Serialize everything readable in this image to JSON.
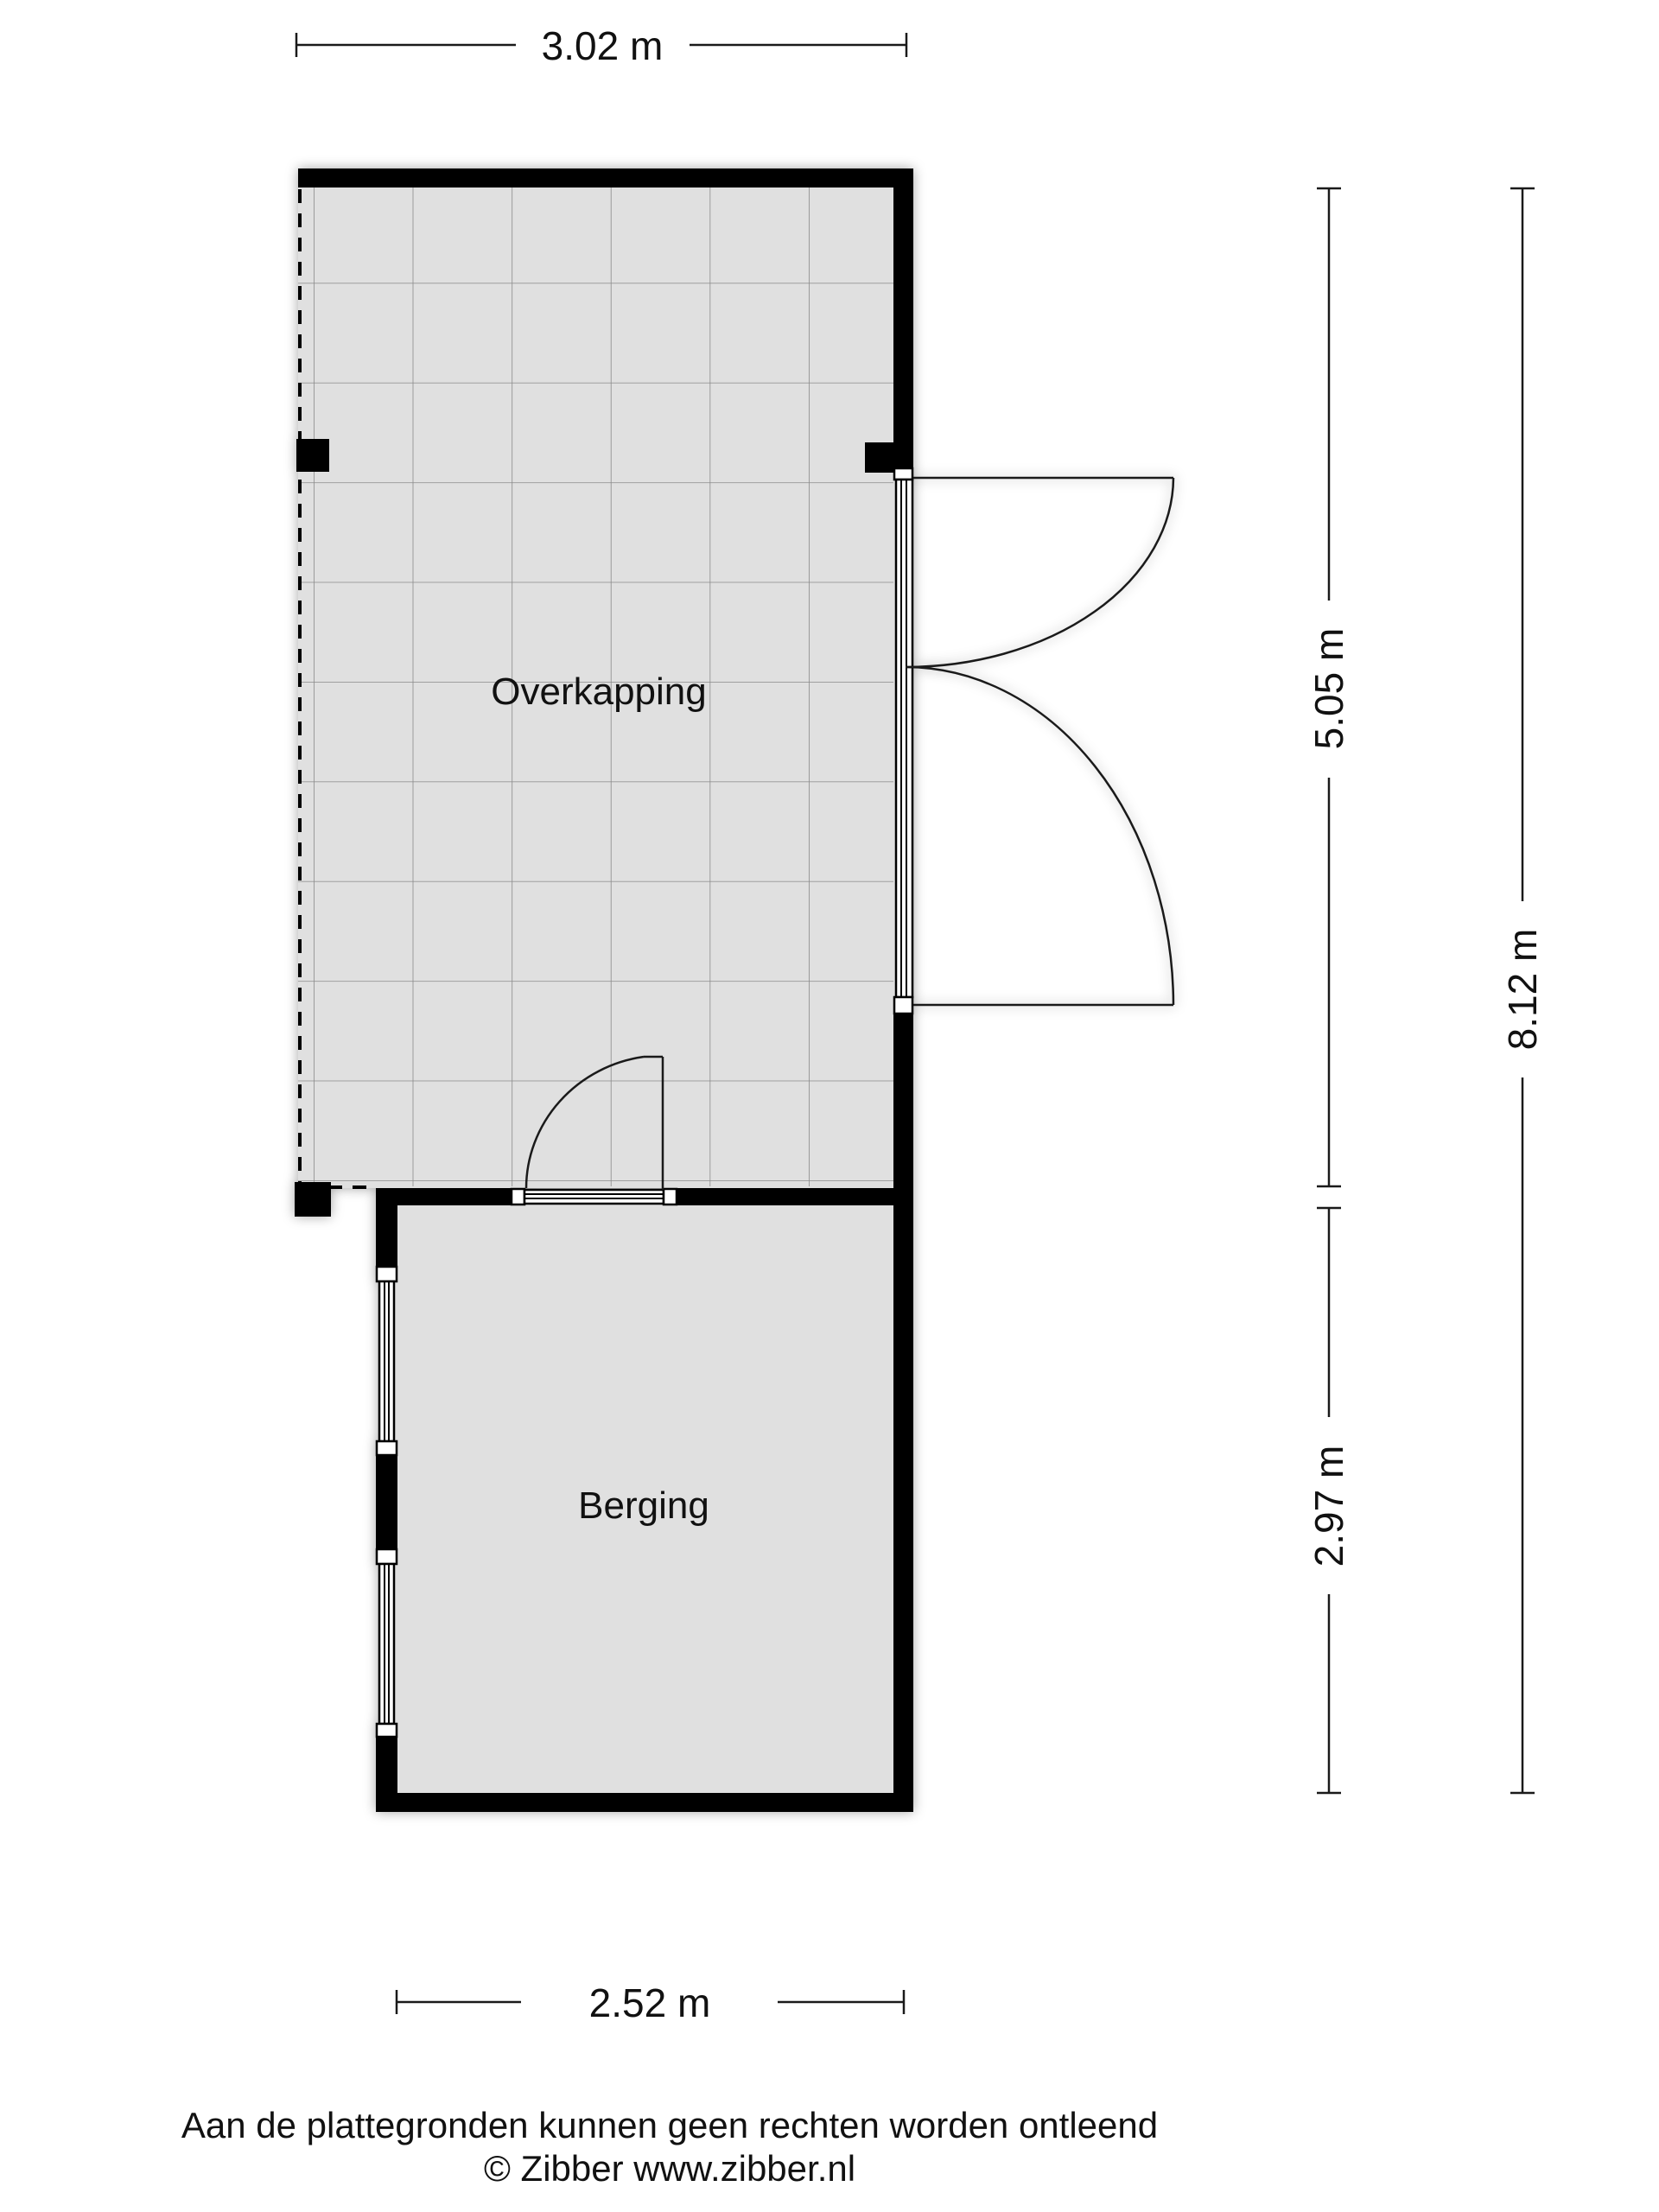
{
  "plan": {
    "rooms": [
      {
        "label": "Overkapping"
      },
      {
        "label": "Berging"
      }
    ],
    "dimensions": {
      "top": {
        "label": "3.02 m"
      },
      "right_inner_upper": {
        "label": "5.05 m"
      },
      "right_inner_lower": {
        "label": "2.97 m"
      },
      "right_outer": {
        "label": "8.12 m"
      },
      "bottom": {
        "label": "2.52 m"
      }
    },
    "footer": {
      "disclaimer": "Aan de plattegronden kunnen geen rechten worden ontleend",
      "copyright": "© Zibber www.zibber.nl"
    },
    "colors": {
      "background": "#ffffff",
      "floor": "#e0e0e0",
      "wall": "#000000",
      "grid_line": "#8a8a8a"
    }
  }
}
